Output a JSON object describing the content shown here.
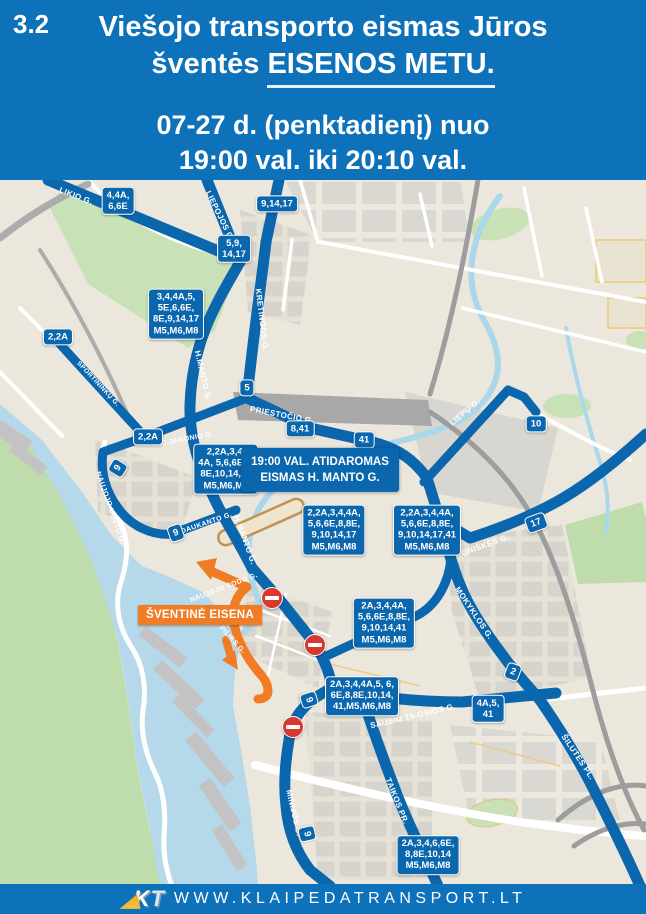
{
  "colors": {
    "header_blue": "#0E72BB",
    "route_blue": "#0A66AD",
    "procession_orange": "#F07D26",
    "no_entry_red": "#D8382E",
    "water": "#B5D9EA",
    "park_green": "#C9E1B6",
    "land": "#EBE7DC",
    "closed_segment_tan": "#C09158"
  },
  "header": {
    "section": "3.2",
    "title_line1": "Viešojo transporto eismas Jūros",
    "title_line2_prefix": "šventės ",
    "title_line2_underlined": "EISENOS METU.",
    "schedule_line1": "07-27 d. (penktadienį) nuo",
    "schedule_line2": "19:00 val. iki 20:10 val."
  },
  "map": {
    "notice": {
      "line1": "19:00 VAL. ATIDAROMAS",
      "line2": "EISMAS H. MANTO G.",
      "x": 320,
      "y": 290
    },
    "procession": {
      "label": "ŠVENTINĖ EISENA",
      "x": 200,
      "y": 435
    },
    "street_labels": [
      {
        "t": "LIKIO G.",
        "x": 76,
        "y": 16,
        "r": 21
      },
      {
        "t": "LIEPOJOS G.",
        "x": 220,
        "y": 36,
        "r": 64
      },
      {
        "t": "KRETINGOS G.",
        "x": 262,
        "y": 140,
        "r": 83
      },
      {
        "t": "H.MANTO G.",
        "x": 203,
        "y": 196,
        "r": 77
      },
      {
        "t": "PRIESTOČIO G.",
        "x": 282,
        "y": 235,
        "r": 11
      },
      {
        "t": "J.JANONIO G.",
        "x": 188,
        "y": 259,
        "r": -11,
        "s": 7
      },
      {
        "t": "SPORTININKŲ G.",
        "x": 98,
        "y": 204,
        "r": 47,
        "s": 6.5
      },
      {
        "t": "NAUJOJO UOSTO G.",
        "x": 110,
        "y": 328,
        "r": 71,
        "s": 7
      },
      {
        "t": "S. DAUKANTO G.",
        "x": 202,
        "y": 345,
        "r": -19,
        "s": 7
      },
      {
        "t": "H.MANTO G.",
        "x": 245,
        "y": 360,
        "r": 70
      },
      {
        "t": "LIEPŲ G.",
        "x": 465,
        "y": 232,
        "r": -40
      },
      {
        "t": "JONIŠKĖS G.",
        "x": 483,
        "y": 366,
        "r": -20
      },
      {
        "t": "MOKYKLOS G.",
        "x": 474,
        "y": 433,
        "r": 56
      },
      {
        "t": "SAUSIO 15-OSIOS G.",
        "x": 413,
        "y": 536,
        "r": -13
      },
      {
        "t": "ŠILUTĖS PL.",
        "x": 578,
        "y": 577,
        "r": 56
      },
      {
        "t": "TAIKOS PR.",
        "x": 397,
        "y": 621,
        "r": 68
      },
      {
        "t": "MINIJOS G.",
        "x": 294,
        "y": 633,
        "r": 77
      },
      {
        "t": "NAUJOJO SODO G.",
        "x": 224,
        "y": 408,
        "r": -21,
        "s": 7,
        "c": "on-orange"
      },
      {
        "t": "PILIES G.",
        "x": 232,
        "y": 460,
        "r": 48,
        "s": 7,
        "c": "on-orange"
      }
    ],
    "badges": [
      {
        "lines": [
          "4,4A,",
          "6,6E"
        ],
        "x": 118,
        "y": 21
      },
      {
        "lines": [
          "9,14,17"
        ],
        "x": 277,
        "y": 24
      },
      {
        "lines": [
          "5,9,",
          "14,17"
        ],
        "x": 234,
        "y": 69
      },
      {
        "lines": [
          "3,4,4A,5,",
          "5E,6,6E,",
          "8E,9,14,17",
          "M5,M6,M8"
        ],
        "x": 176,
        "y": 134
      },
      {
        "lines": [
          "2,2A"
        ],
        "x": 58,
        "y": 157
      },
      {
        "lines": [
          "2,2A"
        ],
        "x": 148,
        "y": 257
      },
      {
        "lines": [
          "5"
        ],
        "x": 247,
        "y": 208
      },
      {
        "lines": [
          "8,41"
        ],
        "x": 300,
        "y": 249
      },
      {
        "lines": [
          "41"
        ],
        "x": 364,
        "y": 260
      },
      {
        "lines": [
          "10"
        ],
        "x": 536,
        "y": 244
      },
      {
        "lines": [
          "9"
        ],
        "x": 118,
        "y": 288,
        "r": -58
      },
      {
        "lines": [
          "9"
        ],
        "x": 176,
        "y": 353,
        "r": -19
      },
      {
        "lines": [
          "2,2A,3,4,",
          "4A, 5,6,6E,8,",
          "8E,10,14,17",
          "M5,M6,M8"
        ],
        "x": 226,
        "y": 289
      },
      {
        "lines": [
          "2,2A,3,4,4A,",
          "5,6,6E,8,8E,",
          "9,10,14,17",
          "M5,M6,M8"
        ],
        "x": 334,
        "y": 350
      },
      {
        "lines": [
          "2,2A,3,4,4A,",
          "5,6,6E,8,8E,",
          "9,10,14,17,41",
          "M5,M6,M8"
        ],
        "x": 427,
        "y": 350
      },
      {
        "lines": [
          "17"
        ],
        "x": 536,
        "y": 343,
        "r": -20
      },
      {
        "lines": [
          "2A,3,4,4A,",
          "5,6,6E,8,8E,",
          "9,10,14,41",
          "M5,M6,M8"
        ],
        "x": 384,
        "y": 443
      },
      {
        "lines": [
          "9"
        ],
        "x": 309,
        "y": 520,
        "r": 72
      },
      {
        "lines": [
          "2A,3,4,4A,5, 6,",
          "6E,8,8E,10,14,",
          "41,M5,M6,M8"
        ],
        "x": 362,
        "y": 516
      },
      {
        "lines": [
          "4A,5,",
          "41"
        ],
        "x": 488,
        "y": 529
      },
      {
        "lines": [
          "2"
        ],
        "x": 513,
        "y": 492,
        "r": 20
      },
      {
        "lines": [
          "9"
        ],
        "x": 307,
        "y": 654,
        "r": 77
      },
      {
        "lines": [
          "2A,3,4,6,6E,",
          "8,8E,10,14",
          "M5,M6,M8"
        ],
        "x": 428,
        "y": 675
      }
    ],
    "no_entry": [
      {
        "x": 272,
        "y": 418
      },
      {
        "x": 315,
        "y": 465
      },
      {
        "x": 293,
        "y": 547
      }
    ]
  },
  "footer": {
    "logo_k": "K",
    "logo_t": "T",
    "url": "WWW.KLAIPEDATRANSPORT.LT"
  }
}
